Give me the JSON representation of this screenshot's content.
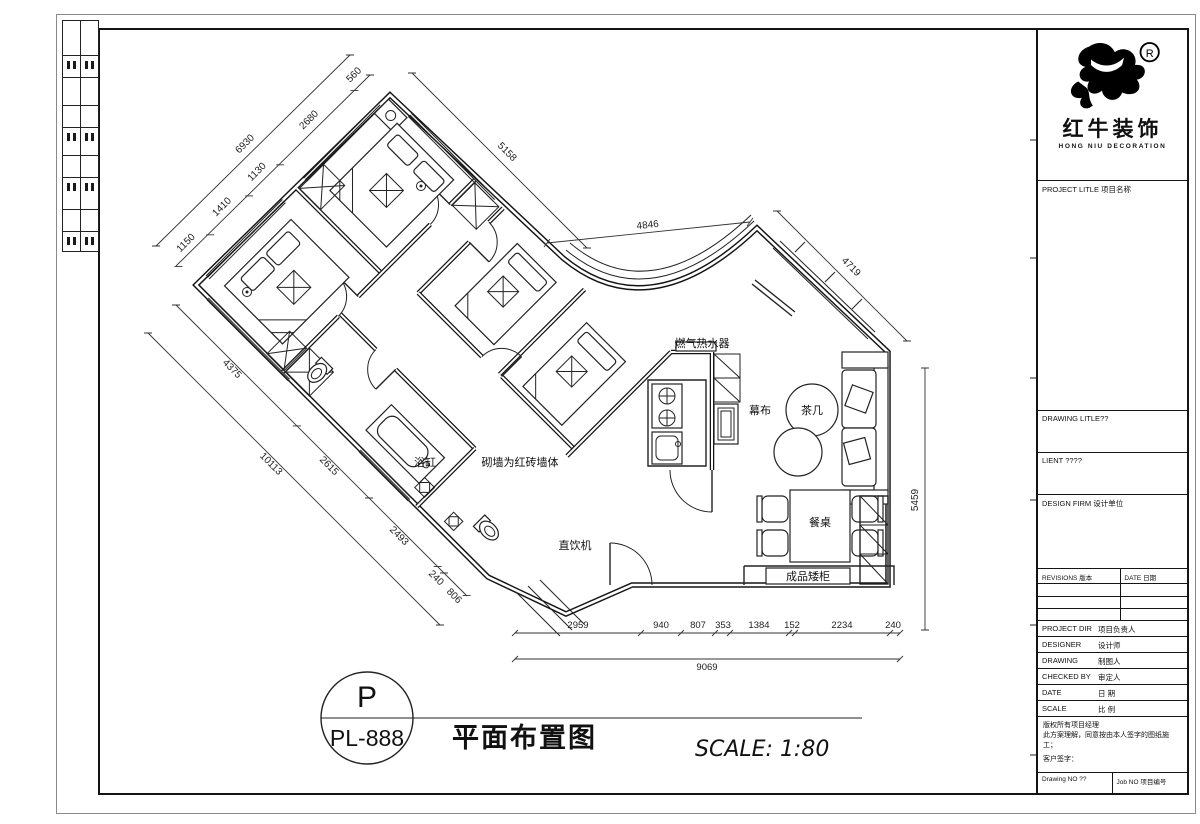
{
  "title_block": {
    "logo": {
      "cn": "红牛装饰",
      "en": "HONG NIU DECORATION",
      "registered": "R"
    },
    "project_row": "PROJECT LITLE 项目名称",
    "drawing_title_row": "DRAWING LITLE??",
    "client_row": "LIENT ????",
    "design_firm_row": "DESIGN FIRM 设计单位",
    "revisions_header": {
      "left": "REVISIONS 版本",
      "right": "DATE 日期"
    },
    "fields": [
      {
        "en": "PROJECT DIR",
        "cn": "项目负责人"
      },
      {
        "en": "DESIGNER",
        "cn": "设计师"
      },
      {
        "en": "DRAWING",
        "cn": "制图人"
      },
      {
        "en": "CHECKED BY",
        "cn": "审定人"
      },
      {
        "en": "DATE",
        "cn": "日 期"
      },
      {
        "en": "SCALE",
        "cn": "比 例"
      }
    ],
    "copyright": {
      "line1": "版权所有项目经理",
      "line2": "此方案理解，同意按由本人签字的图纸施工；",
      "line3": "客户签字："
    },
    "drawing_no": "Drawing NO ??",
    "job_no": "Job NO 项目编号"
  },
  "footer": {
    "code_letter": "P",
    "code_number": "PL-888",
    "drawing_title": "平面布置图",
    "scale_note": "SCALE: 1:80"
  },
  "plan": {
    "labels": {
      "water_heater": "燃气热水器",
      "screen": "幕布",
      "tea_table": "茶几",
      "dining_table": "餐桌",
      "cabinet": "成品矮柜",
      "bathtub": "浴缸",
      "brick_note": "砌墙为红砖墙体",
      "water_dispenser": "直饮机"
    },
    "dims": {
      "nw": [
        "560",
        "2680",
        "1130",
        "1410",
        "1150"
      ],
      "nw_total": "6930",
      "ne": "5158",
      "top": "4846",
      "right_diag": "4719",
      "right_v": "5459",
      "sw": [
        "4375",
        "2615",
        "2493",
        "240",
        "806"
      ],
      "sw_total": "10113",
      "bottom": [
        "2959",
        "940",
        "807",
        "353",
        "1384",
        "152",
        "2234",
        "240"
      ],
      "bottom_total": "9069"
    }
  }
}
